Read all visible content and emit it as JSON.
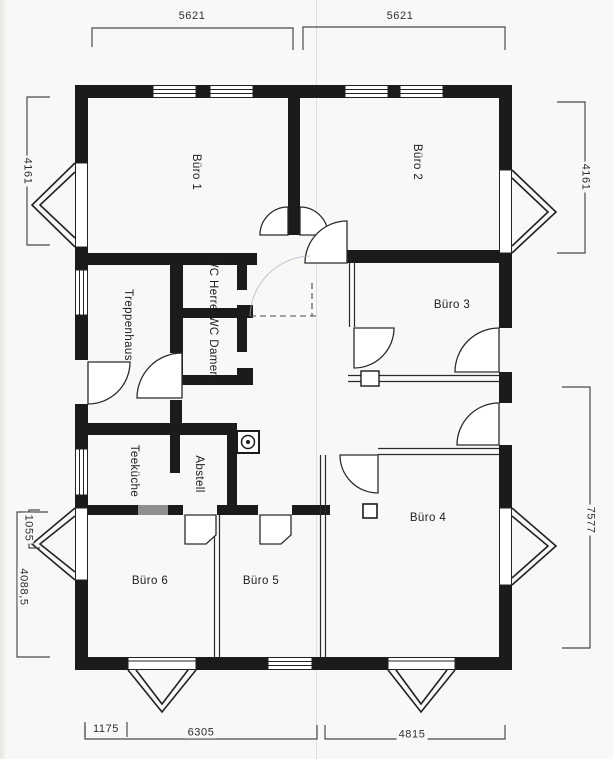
{
  "plan": {
    "rooms": [
      {
        "id": "buero1",
        "label": "Büro 1"
      },
      {
        "id": "buero2",
        "label": "Büro 2"
      },
      {
        "id": "buero3",
        "label": "Büro 3"
      },
      {
        "id": "buero4",
        "label": "Büro 4"
      },
      {
        "id": "buero5",
        "label": "Büro 5"
      },
      {
        "id": "buero6",
        "label": "Büro 6"
      },
      {
        "id": "treppenhaus",
        "label": "Treppenhaus"
      },
      {
        "id": "wc-herren",
        "label": "WC Herren"
      },
      {
        "id": "wc-damen",
        "label": "WC Damen"
      },
      {
        "id": "teekueche",
        "label": "Teeküche"
      },
      {
        "id": "abstell",
        "label": "Abstell"
      }
    ],
    "dimensions": {
      "top_left": "5621",
      "top_right": "5621",
      "left_upper": "4161",
      "right_upper": "4161",
      "left_bay": "1055",
      "left_lower": "4088,5",
      "right_lower": "7577",
      "bottom_offset": "1175",
      "bottom_left": "6305",
      "bottom_right": "4815"
    },
    "colors": {
      "wall": "#1b1b1b",
      "line": "#2e2e2e",
      "dimension_line": "#4a4a4a",
      "paper": "#f9f8f6",
      "shaded_wall": "#8f8f8f"
    }
  }
}
